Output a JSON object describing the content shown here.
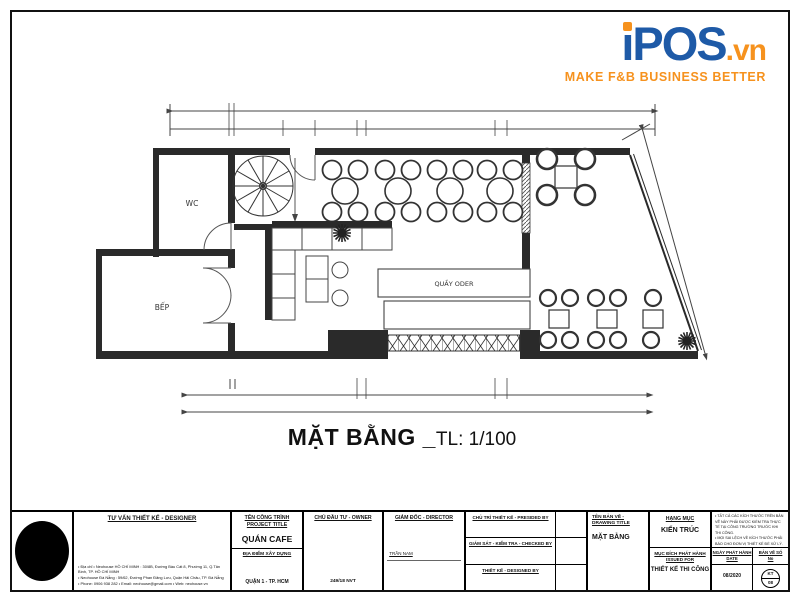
{
  "logo": {
    "brand_i": "i",
    "brand_rest": "POS",
    "suffix": ".vn",
    "tagline": "MAKE F&B BUSINESS BETTER",
    "color_blue": "#1e5aa7",
    "color_orange": "#f6921e"
  },
  "plan": {
    "rooms": {
      "wc": "WC",
      "kitchen": "BẾP",
      "order_counter": "QUẦY ODER"
    }
  },
  "drawing_caption": {
    "title": "MẶT BẰNG _",
    "scale": "TL: 1/100"
  },
  "titleblock": {
    "designer": {
      "header": "TƯ VẤN THIẾT KẾ - DESIGNER",
      "address_lines": [
        "• Địa chỉ • Neohouse HỒ CHÍ MINH : 30/8B, Đường Bàu Cát 8, Phường 11, Q.Tân Bình, TP. HỒ CHÍ MINH",
        "• Neohouse Đà Nẵng : 59/62, Đường Phan Đăng Lưu, Quận Hải Châu, TP. Đà Nẵng",
        "• Phone: 0906 938 282 • Email: neohouse@gmail.com • Web: neohouse.vn"
      ]
    },
    "project": {
      "header1": "TÊN CÔNG TRÌNH",
      "header2": "PROJECT TITLE",
      "name": "QUÁN CAFE",
      "location_label": "ĐỊA ĐIỂM XÂY DỰNG",
      "location_value": "QUẬN 1 - TP. HCM"
    },
    "owner": {
      "header": "CHỦ ĐẦU TƯ - OWNER",
      "value": "249/18 NVT"
    },
    "director": {
      "header": "GIÁM ĐỐC - DIRECTOR",
      "value": "TRẦN NAM"
    },
    "approvals": [
      "CHỦ TRÌ THIẾT KẾ - PRESIDED BY",
      "GIÁM SÁT - KIỂM TRA - CHECKED BY",
      "THIẾT KẾ - DESIGNED BY"
    ],
    "drawing": {
      "header": "TÊN BẢN VẼ - DRAWING TITLE",
      "value": "MẶT BẰNG"
    },
    "category": {
      "header": "HẠNG MỤC",
      "value": "KIẾN TRÚC"
    },
    "issue": {
      "header1": "MỤC ĐÍCH PHÁT HÀNH",
      "header2": "ISSUED FOR",
      "value": "THIẾT KẾ THI CÔNG"
    },
    "notes": [
      "• TẤT CẢ CÁC KÍCH THƯỚC TRÊN BẢN VẼ NÀY PHẢI ĐƯỢC KIỂM TRA THỰC TẾ TẠI CÔNG TRƯỜNG TRƯỚC KHI THI CÔNG.",
      "• MỌI SAI LỆCH VỀ KÍCH THƯỚC PHẢI BÁO CHO ĐƠN VỊ THIẾT KẾ ĐỂ XỬ LÝ."
    ],
    "date": {
      "header1": "NGÀY PHÁT HÀNH",
      "header2": "DATE",
      "value": "08/2020"
    },
    "sheet_no": {
      "header1": "BẢN VẼ SỐ",
      "header2": "No",
      "value_top": "KT",
      "value_bottom": "08"
    }
  }
}
